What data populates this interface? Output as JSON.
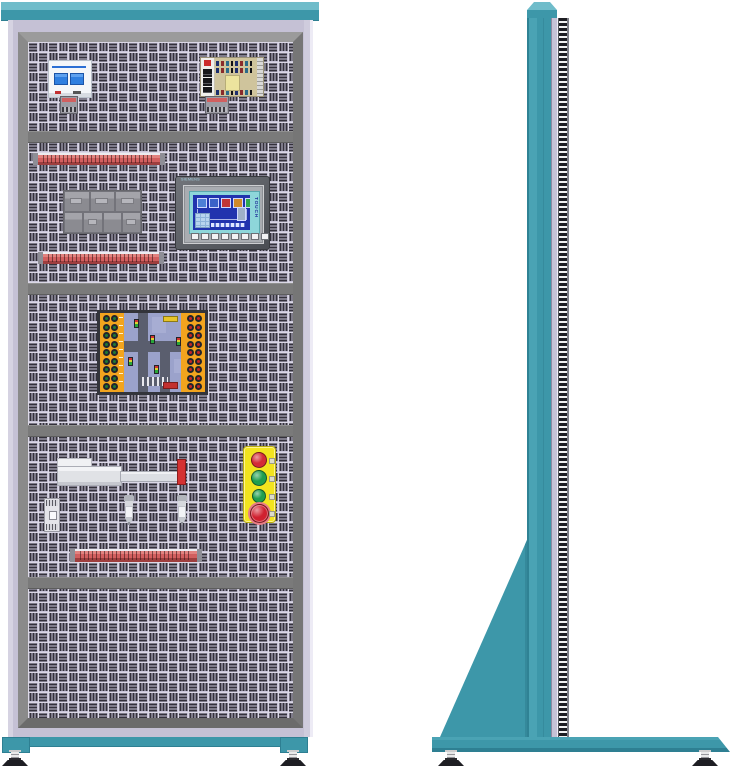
{
  "title": "PLC training cabinet - front and side elevation drawing",
  "palette": {
    "teal": "#3D97A9",
    "teal_light": "#6FBCCA",
    "teal_dark": "#2E7F92",
    "lavender": "#C5C1D5",
    "frame_gray": "#8C8C8C",
    "divider_gray": "#7A7A7A",
    "panel_light": "#C9C5D9",
    "perforation_dark": "#34313B",
    "rail_red": "#D25F5F",
    "yellow_station": "#F2E41E",
    "button_red": "#D42B36",
    "button_green": "#1F9E4E",
    "estop_red": "#D0202F",
    "board_orange": "#F2A41E",
    "board_blue": "#9BA2CB",
    "hmi_screen_blue": "#2133AE",
    "hmi_frame_teal": "#8ED6DA",
    "foot_black": "#1E1E23"
  },
  "front_view": {
    "label": "front elevation",
    "components": {
      "breaker": {
        "type": "2-pole circuit breaker"
      },
      "power_supply": {
        "type": "open-frame switching power supply"
      },
      "terminal_rails": {
        "count": 3
      },
      "plc_block": {
        "type": "plc module assembly"
      },
      "hmi": {
        "brand": "SIEMENS",
        "touch_label": "TOUCH",
        "function_keys": 8,
        "screen_tanks": [
          "#4D7FD6",
          "#3A62C8",
          "#C23535",
          "#D08A2A",
          "#2FA84F"
        ]
      },
      "traffic_board": {
        "type": "traffic-light training board",
        "left_jacks": {
          "rows": 9,
          "cols": 2,
          "color": "#1E7A35"
        },
        "right_jacks": {
          "rows": 9,
          "cols": 2,
          "color": "#C42525"
        }
      },
      "linear_actuator": {
        "type": "electric cylinder with red end flag"
      },
      "sensors": {
        "count": 3
      },
      "button_station": {
        "buttons": [
          {
            "kind": "pushbutton",
            "color": "#D42B36",
            "size": 16
          },
          {
            "kind": "pushbutton",
            "color": "#1F9E4E",
            "size": 16
          },
          {
            "kind": "pushbutton",
            "color": "#1F9E4E",
            "size": 14
          },
          {
            "kind": "emergency-stop",
            "color": "#D0202F",
            "size": 19
          }
        ]
      }
    },
    "feet": 2
  },
  "side_view": {
    "label": "side elevation",
    "feet": 2
  }
}
